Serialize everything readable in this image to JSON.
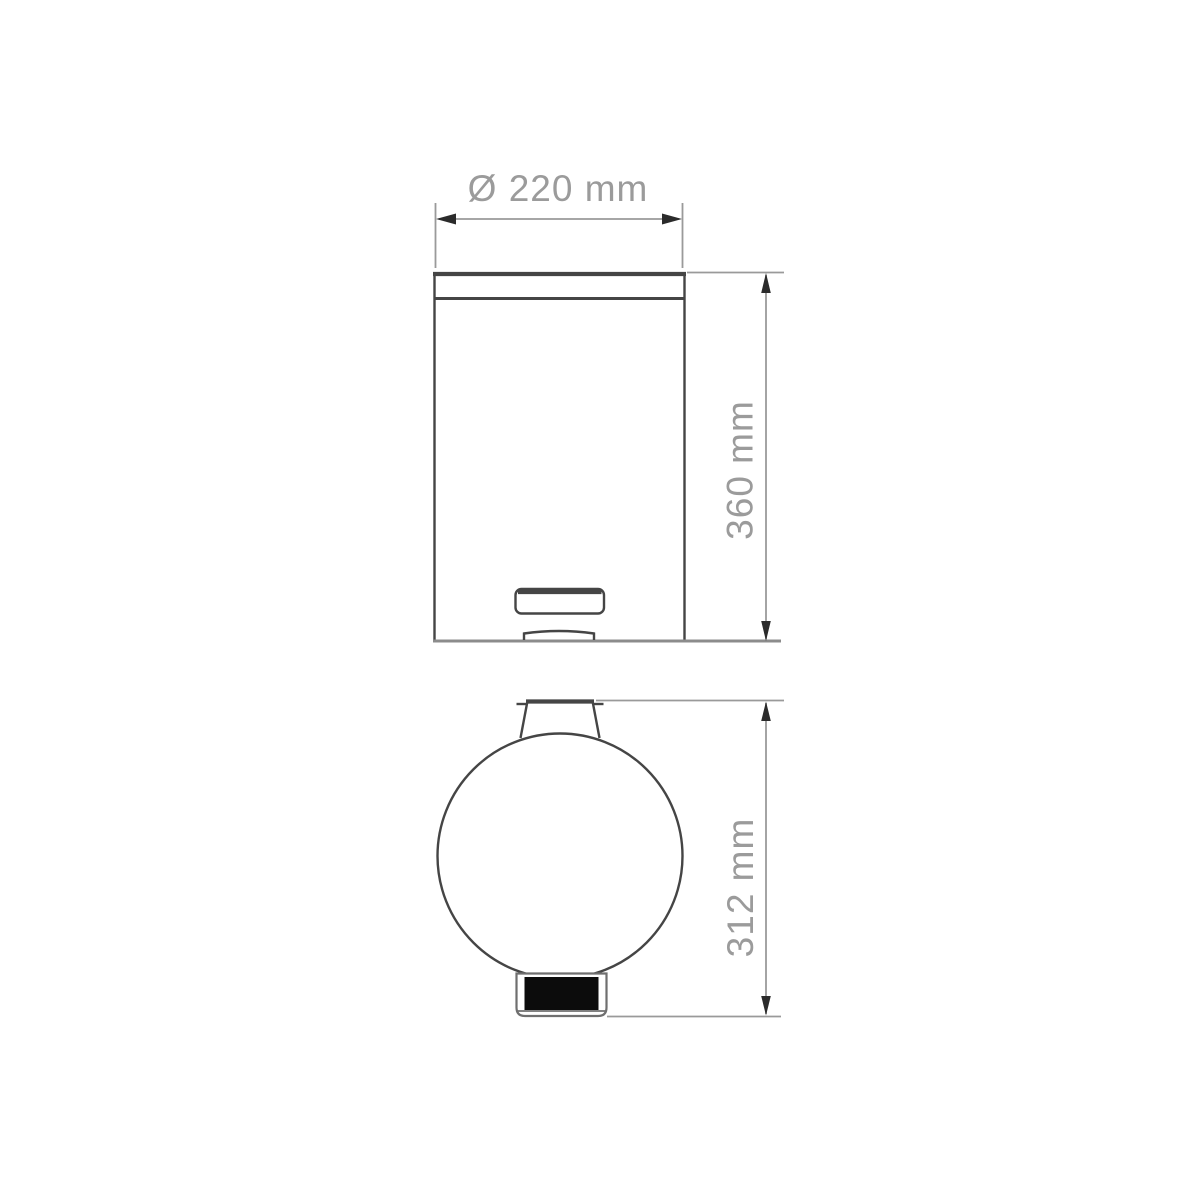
{
  "diagram": {
    "type": "technical-drawing",
    "views": {
      "front": "front-elevation",
      "top": "plan-view"
    },
    "dimensions": {
      "diameter_label": "Ø 220 mm",
      "diameter_value_mm": 220,
      "height_label": "360 mm",
      "height_value_mm": 360,
      "depth_label": "312 mm",
      "depth_value_mm": 312,
      "unit": "mm"
    },
    "colors": {
      "background": "#ffffff",
      "outline": "#454545",
      "ground_line": "#8c8c8c",
      "dimension_line": "#9a9a9a",
      "arrow": "#2b2b2b",
      "label_text": "#9b9b9b",
      "pedal_outline": "#6f6f6f",
      "pedal_fill": "#0c0c0c"
    }
  }
}
